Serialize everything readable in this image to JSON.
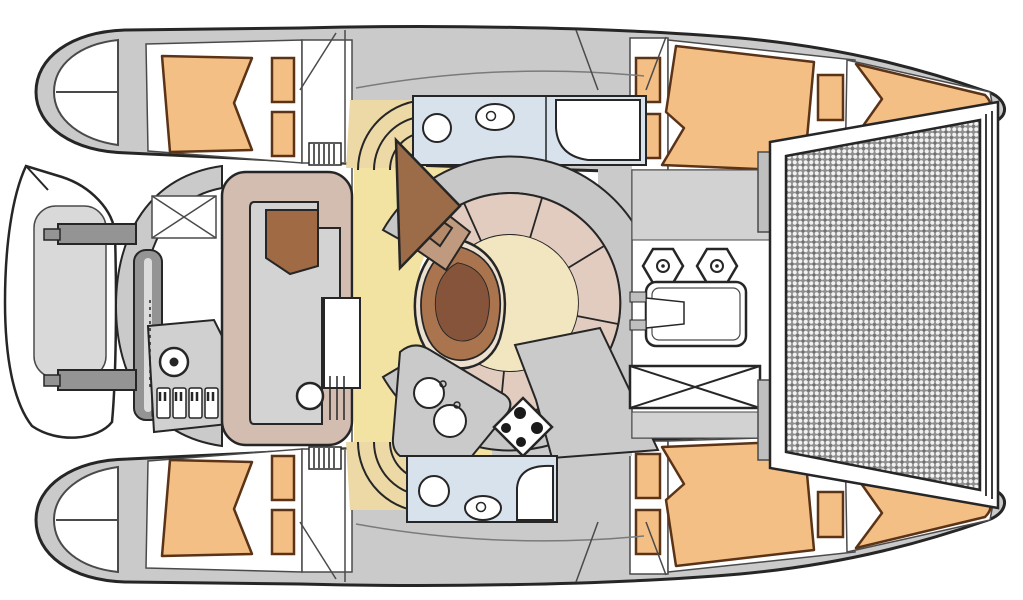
{
  "figure": {
    "kind": "boat-deck-floor-plan",
    "subject": "catamaran-top-view",
    "orientation": "bow-right-stern-left"
  },
  "colors": {
    "background": "#ffffff",
    "outline": "#262626",
    "seam": "#4a4a4a",
    "light_seam": "#7a7a7a",
    "deck_gray": "#cacaca",
    "deck_gray_mid": "#d2d2d2",
    "room_white": "#ffffff",
    "bed_orange": "#f4bf85",
    "bed_border": "#5b3317",
    "sole_yellow": "#f3e3a3",
    "sole_pale": "#f1e6c0",
    "steps_tan": "#ecd9a6",
    "bath_blue": "#d8e2ec",
    "seat_tan": "#d3bcb0",
    "dinette_pink": "#e2cbbf",
    "backrest_gray": "#c7c7c7",
    "cushion_brown": "#a06a44",
    "helm_brown": "#9c6c49",
    "table_brown": "#a9744e",
    "table_brown_dark": "#85543a",
    "table_cream": "#ece0d0",
    "table_gray": "#d3d3d3",
    "console_gray": "#d0d0d0",
    "net_gray": "#8e8e8e",
    "net_line": "#6f6f6f",
    "net_dot": "#f2f2f2",
    "dinghy_inner": "#d9d9d9",
    "davit_gray": "#949494",
    "davit_stripe": "#dcdcdc",
    "tab_gray": "#bfbfbf",
    "burner_dark": "#1a1a1a"
  },
  "regions": [
    "port-hull",
    "starboard-hull",
    "port-aft-cabin-berth",
    "port-forward-cabin-berth",
    "starboard-aft-cabin-berth",
    "starboard-forward-cabin-berth",
    "port-bathroom",
    "starboard-bathroom",
    "salon-dinette",
    "salon-table",
    "galley",
    "stove",
    "galley-sinks",
    "cockpit-settee",
    "cockpit-table",
    "helm-console",
    "steering-wheel",
    "engine-switch-panel",
    "dinghy",
    "davit-arms",
    "transom-platform",
    "companionway-steps",
    "cabin-step-arcs",
    "foredeck",
    "winches",
    "deck-hatch",
    "anchor-locker",
    "trampoline-net",
    "bow-locker"
  ],
  "counts": {
    "double_berths": 4,
    "bathrooms": 2,
    "toilets": 2,
    "showers": 2,
    "bathroom_sinks": 2,
    "galley_sinks": 2,
    "stove_burners": 4,
    "winches": 2,
    "small_deck_hatches": 10,
    "companionway_step_sets": 2,
    "engine_switches": 4
  }
}
